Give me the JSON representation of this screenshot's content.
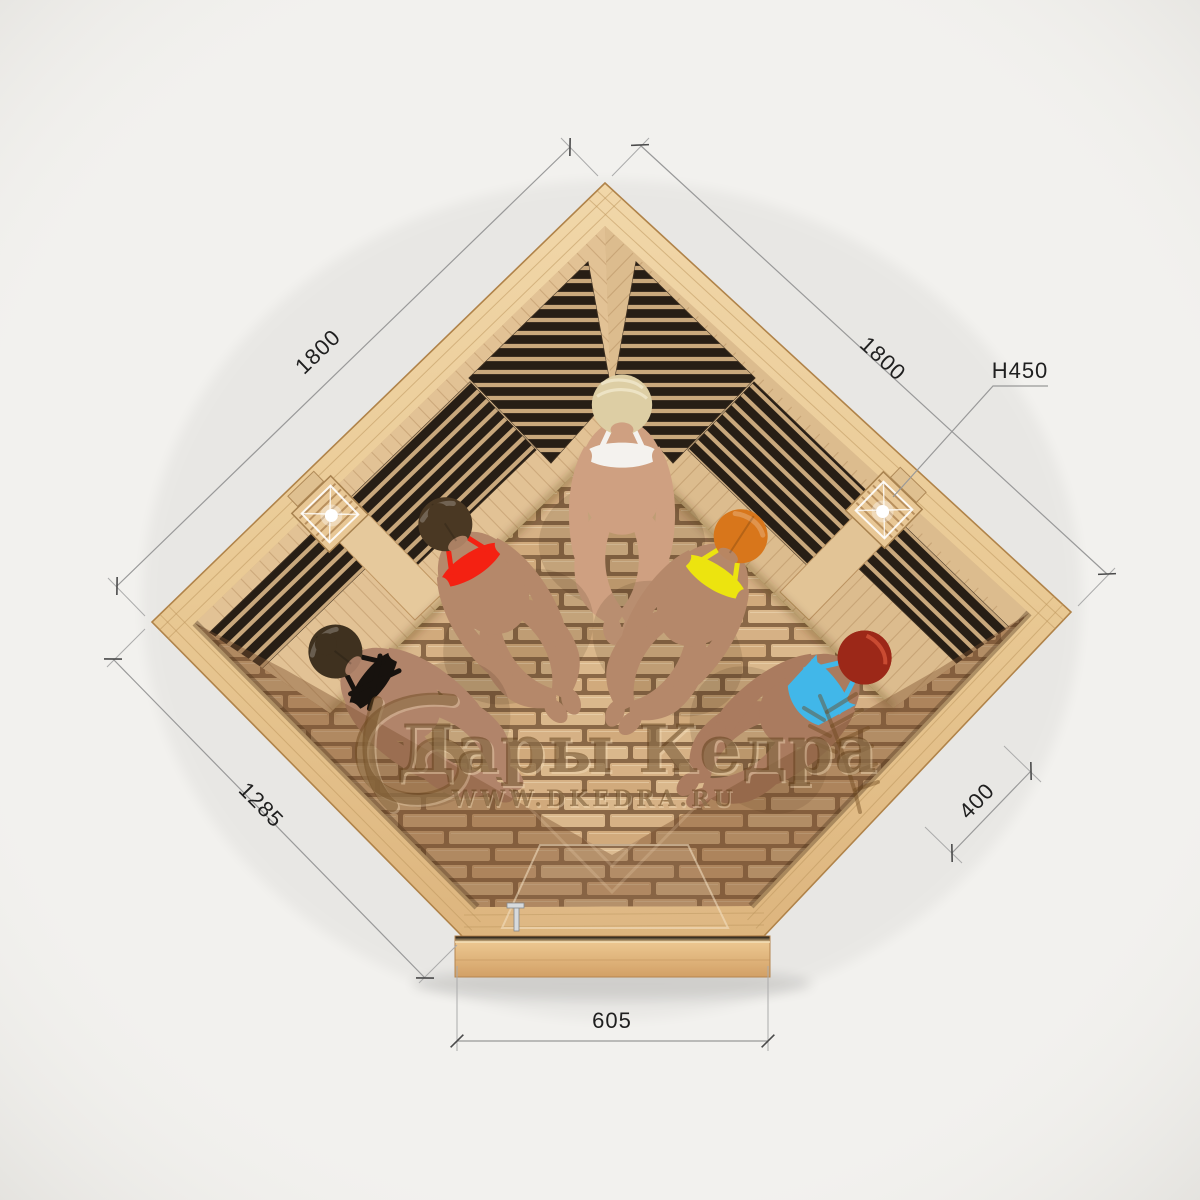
{
  "watermark": {
    "brand": "Дары Кедра",
    "website": "WWW.DKEDRA.RU"
  },
  "dimensions": {
    "left_wall": "1800",
    "right_wall": "1800",
    "height_note": "H450",
    "front_left_bevel": "1285",
    "front_right_bevel": "400",
    "door_width": "605"
  },
  "people": [
    {
      "position": "far-left",
      "hair_color": "#3f311f",
      "swimsuit_color": "#17120e",
      "skin_color": "#b1846a"
    },
    {
      "position": "left",
      "hair_color": "#4a3823",
      "swimsuit_color": "#f42112",
      "skin_color": "#b5886a"
    },
    {
      "position": "center",
      "hair_color": "#ddcea4",
      "swimsuit_color": "#f4f2ee",
      "skin_color": "#cfa081"
    },
    {
      "position": "right",
      "hair_color": "#d8761b",
      "swimsuit_color": "#ece40f",
      "skin_color": "#b5886a"
    },
    {
      "position": "far-right",
      "hair_color": "#9c2818",
      "swimsuit_color": "#41b7e9",
      "skin_color": "#aa7b5f"
    }
  ],
  "colors": {
    "background": "#f2f1ee",
    "wood_rim": "#ecce9e",
    "wood_wall": "#e0c094",
    "wood_floor_gap": "#8a6847",
    "heater_panel": "#271e15",
    "glass_tint": "#7c522f",
    "dimension_line": "#999999",
    "dimension_text": "#1f1f1f",
    "watermark_text": "#5f3f1a"
  }
}
